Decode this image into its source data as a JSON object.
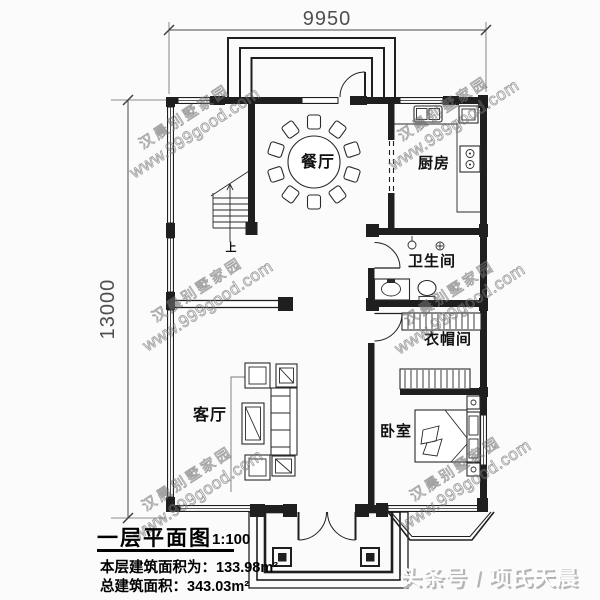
{
  "colors": {
    "ink": "#1f1f1f",
    "dimension": "#4a4a4a",
    "watermark_gray": "#696969",
    "banner_shadow": "#b5b5b5",
    "background": "#fbfbfb"
  },
  "dimensions": {
    "top_width": "9950",
    "left_height": "13000"
  },
  "rooms": {
    "dining": "餐厅",
    "kitchen": "厨房",
    "bathroom": "卫生间",
    "cloakroom": "衣帽间",
    "living": "客厅",
    "bedroom": "卧室",
    "stairs_up": "上"
  },
  "title_block": {
    "title": "一层平面图",
    "scale": "1:100",
    "floor_area": "本层建筑面积为：133.98m²",
    "total_area": "总建筑面积：343.03m²"
  },
  "watermark": {
    "line1": "汉晨别墅家园",
    "line2": "www.999good.com"
  },
  "banner": {
    "source": "头条号 / 项氏天晨"
  }
}
